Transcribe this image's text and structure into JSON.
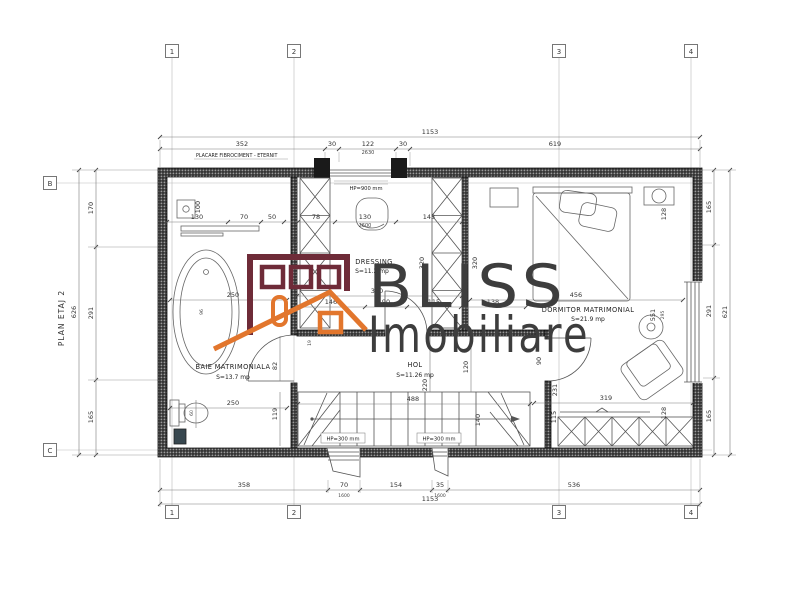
{
  "plan": {
    "title": "PLAN ETAJ 2"
  },
  "watermark": {
    "brand": "BLISS",
    "sub": "Imobiliare",
    "colors": {
      "maroon": "#6e2b38",
      "orange": "#e2762d",
      "text": "#3d3d3d"
    }
  },
  "grid": {
    "cols": [
      "1",
      "2",
      "3",
      "4"
    ],
    "rows": [
      "B",
      "C"
    ]
  },
  "rooms": [
    {
      "name": "BAIE MATRIMONIALA",
      "area": "S=13.7 mp"
    },
    {
      "name": "DRESSING",
      "area": "S=11.2 mp"
    },
    {
      "name": "HOL",
      "area": "S=11.26 mp"
    },
    {
      "name": "DORMITOR MATRIMONIAL",
      "area": "S=21.9 mp"
    }
  ],
  "annotations": {
    "cladding": "PLACARE FIBROCIMENT - ETERNIT",
    "hp_window": "HP=900 mm",
    "hp_left": "HP=300 mm",
    "hp_right": "HP=300 mm"
  },
  "dims": {
    "top_total": "1153",
    "top": [
      "352",
      "30",
      "122",
      "30",
      "619"
    ],
    "top_sub": "2630",
    "bottom": [
      "358",
      "70",
      "154",
      "35",
      "536"
    ],
    "bottom_sub": [
      "1600",
      "1600"
    ],
    "bottom_total": "1153",
    "left": [
      "170",
      "291",
      "165"
    ],
    "left_total": "626",
    "right": [
      "165",
      "291",
      "165"
    ],
    "right_total": "621",
    "upper": [
      "130",
      "70",
      "50",
      "78",
      "130",
      "143"
    ],
    "upper_sub": "2600",
    "dressing_width": "360",
    "mid": [
      "146",
      "90",
      "115",
      "138"
    ],
    "bedroom_width": "456",
    "stair_width": "488",
    "wardrobe_width": "319",
    "bath_w": "250",
    "bath_w2": "250",
    "tub": "96",
    "wc": "60",
    "door_bath": "82",
    "v119": "119",
    "wall11": "11",
    "v19": "19",
    "vanity": "100",
    "wr_left": "320",
    "wr_right": "320",
    "hol_depth": "220",
    "stair_v": "140",
    "hol_v": "120",
    "door_bed": "90",
    "v231": "231",
    "v115": "115",
    "bed_top": "128",
    "win_v": "551",
    "win_v2": "295",
    "bed_bottom": "128"
  }
}
